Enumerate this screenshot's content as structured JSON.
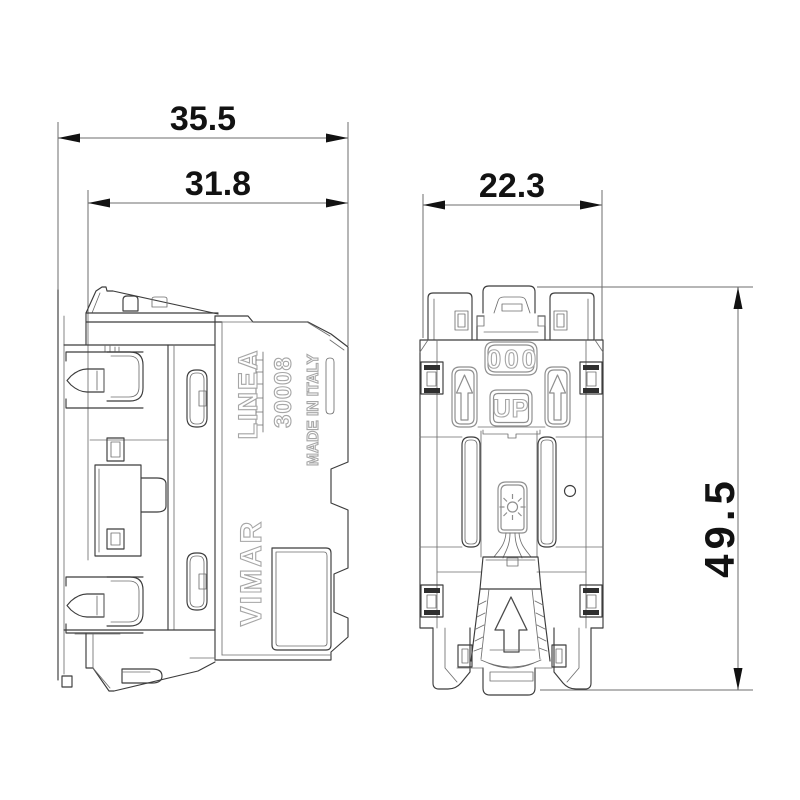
{
  "drawing": {
    "type": "technical-dimension-drawing",
    "views": [
      "side-view",
      "rear-view"
    ],
    "colors": {
      "background": "#ffffff",
      "outline": "#3c3c3c",
      "dimension_line": "#6e6e6e",
      "dimension_text": "#121212",
      "embossed_text": "#a6a6a6"
    }
  },
  "dimensions": {
    "overall_width": "35.5",
    "recess_width": "31.8",
    "module_width": "22.3",
    "module_height": "49.5"
  },
  "side_view_markings": {
    "series": "LINEA",
    "model": "30008",
    "origin": "MADE IN ITALY",
    "brand": "VIMAR"
  },
  "rear_view_markings": {
    "code": "000",
    "orientation": "UP"
  }
}
